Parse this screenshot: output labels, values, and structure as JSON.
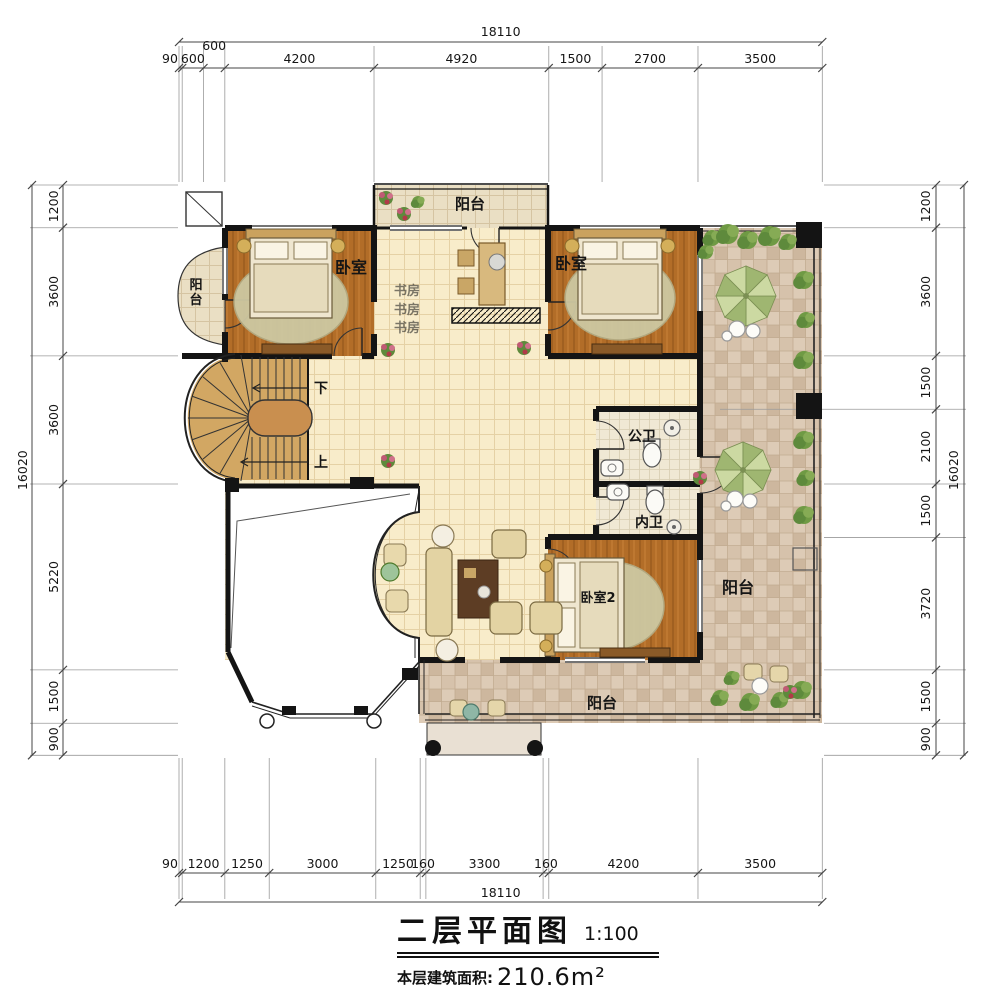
{
  "title": {
    "name": "二层平面图",
    "scale": "1:100",
    "area_label": "本层建筑面积:",
    "area_value": "210.6m²"
  },
  "rooms": {
    "balcony_top": "阳台",
    "balcony_left": "阳台",
    "bedroom_left": "卧室",
    "study": "书房",
    "bedroom_right": "卧室",
    "bath_public": "公卫",
    "bath_private": "内卫",
    "bedroom_2": "卧室2",
    "terrace_right": "阳台",
    "balcony_bottom": "阳台",
    "stair_down": "下",
    "stair_up": "上"
  },
  "dimensions": {
    "top": {
      "total": "18110",
      "segments": [
        "90",
        "600",
        "600",
        "4200",
        "4920",
        "1500",
        "2700",
        "3500"
      ]
    },
    "bottom": {
      "total": "18110",
      "segments": [
        "90",
        "1200",
        "1250",
        "3000",
        "1250",
        "160",
        "3300",
        "160",
        "4200",
        "3500"
      ]
    },
    "left": {
      "total": "16020",
      "segments": [
        "1200",
        "3600",
        "3600",
        "5220",
        "1500",
        "900"
      ]
    },
    "right": {
      "total": "16020",
      "segments": [
        "1200",
        "3600",
        "1500",
        "2100",
        "1500",
        "3720",
        "1500",
        "900"
      ]
    }
  },
  "colors": {
    "wall": "#141414",
    "wood_floor": "#b26d28",
    "tile_floor": "#f8ecca",
    "terrace_floor": "#ddcbb6",
    "greenery": "#5e8a3c",
    "dim_line": "#444444"
  }
}
